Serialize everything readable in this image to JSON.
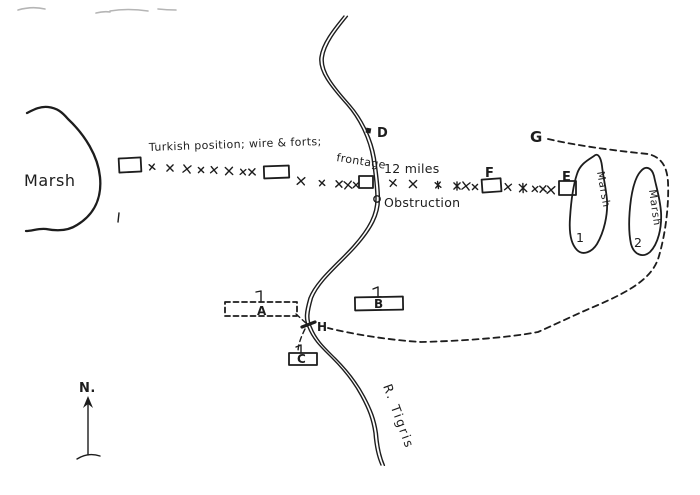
{
  "colors": {
    "ink": "#1d1d1d",
    "paper": "#ffffff",
    "faint_mark": "#b5b5b5"
  },
  "labels": {
    "marsh_left": "Marsh",
    "turkish_caption_1": "Turkish position; wire & forts;",
    "turkish_caption_2": "frontage",
    "miles": "12 miles",
    "obstruction": "Obstruction",
    "river": "R. Tigris",
    "north": "N.",
    "point_d": "D",
    "point_f": "F",
    "point_e": "E",
    "point_g": "G",
    "point_h": "H",
    "camp_a": "A",
    "camp_b": "B",
    "camp_c": "C",
    "marsh_1_name": "Marsh",
    "marsh_1_number": "1",
    "marsh_2_name": "Marsh",
    "marsh_2_number": "2"
  }
}
